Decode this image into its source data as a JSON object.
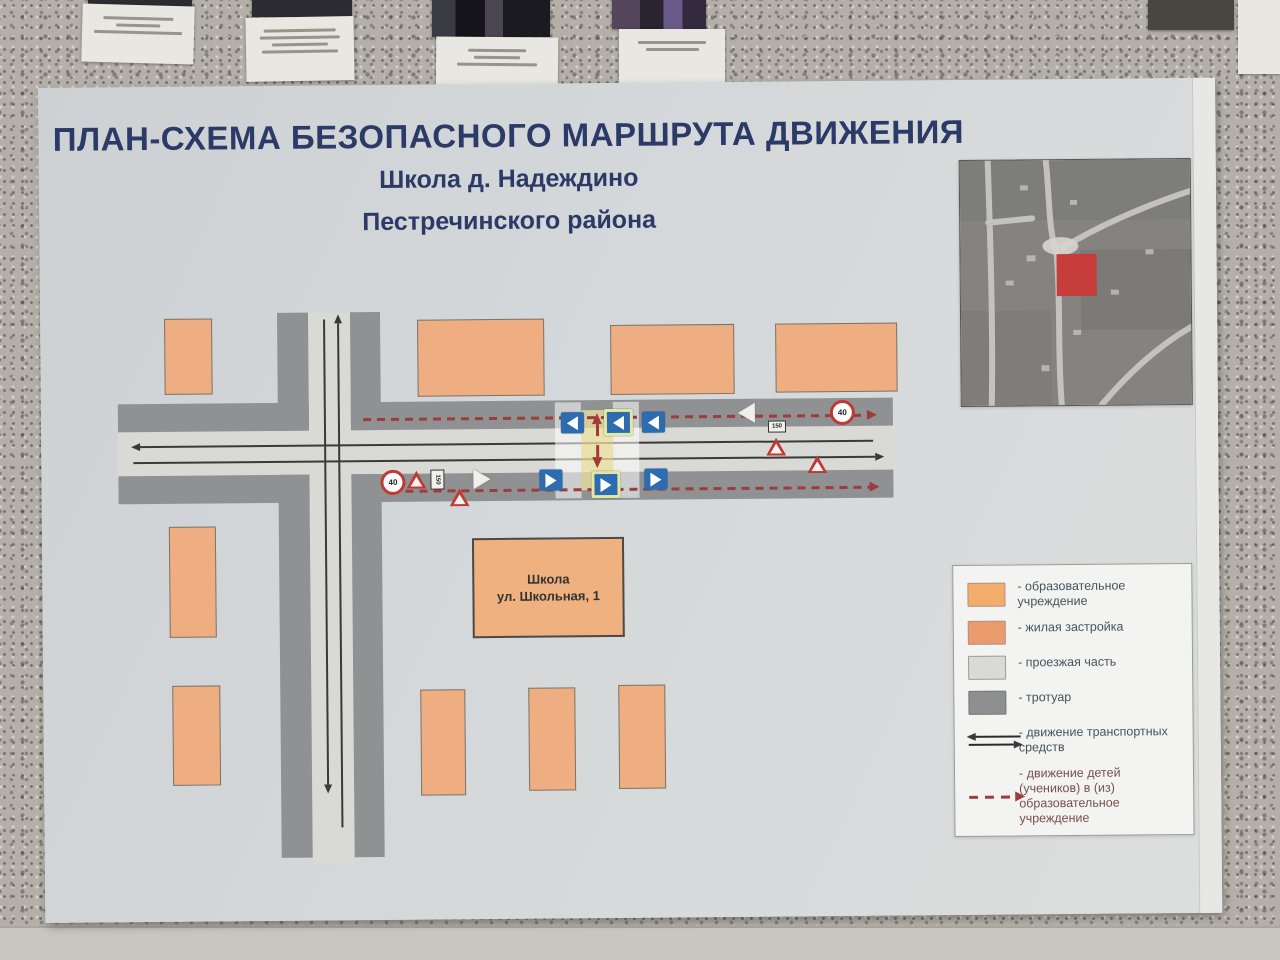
{
  "poster": {
    "title_line1": "ПЛАН-СХЕМА БЕЗОПАСНОГО МАРШРУТА ДВИЖЕНИЯ",
    "title_line2": "Школа д. Надеждино",
    "title_line3": "Пестречинского района"
  },
  "map": {
    "school_label_line1": "Школа",
    "school_label_line2": "ул. Школьная, 1",
    "speed_sign": "40",
    "distance_plate": "150"
  },
  "legend": {
    "items": [
      {
        "key": "education",
        "label": "- образовательное учреждение",
        "color": "#f2ad6d"
      },
      {
        "key": "residential",
        "label": "- жилая застройка",
        "color": "#ea9b6e"
      },
      {
        "key": "roadway",
        "label": "- проезжая часть",
        "color": "#d9d9d6"
      },
      {
        "key": "sidewalk",
        "label": "- тротуар",
        "color": "#8d8f90"
      },
      {
        "key": "vehicle-traffic",
        "label": "- движение транспортных средств"
      },
      {
        "key": "children-route",
        "label": "- движение детей (учеников) в (из) образовательное учреждение",
        "color": "#9d3c3c"
      }
    ]
  },
  "colors": {
    "title_text": "#2b3a66",
    "building_fill": "#efae82",
    "sidewalk": "#8f9193",
    "roadway": "#d9d9d6",
    "children_route": "#9d3c3c",
    "pedestrian_sign_blue": "#2e6cb2",
    "satellite_marker_red": "#c63d3c"
  }
}
